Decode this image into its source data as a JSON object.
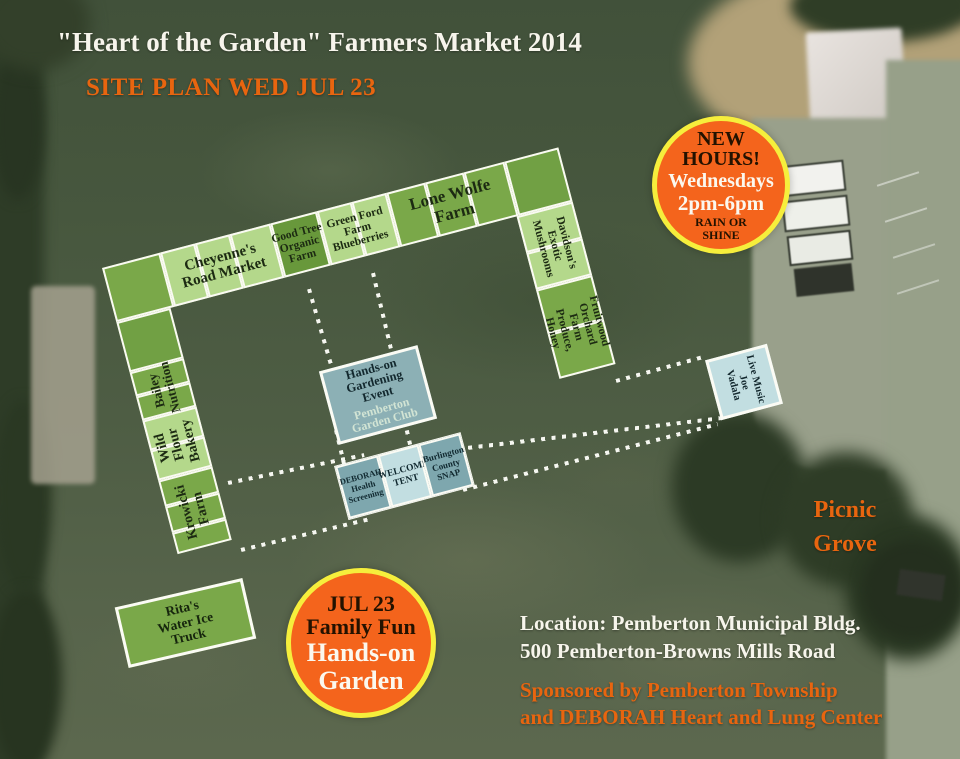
{
  "header": {
    "title": "\"Heart of the Garden\" Farmers Market 2014",
    "subtitle": "SITE PLAN WED JUL 23"
  },
  "new_hours_badge": {
    "l1": "NEW",
    "l2": "HOURS!",
    "l3": "Wednesdays",
    "l4": "2pm-6pm",
    "l5": "RAIN OR",
    "l6": "SHINE"
  },
  "family_fun_badge": {
    "l1": "JUL 23",
    "l2": "Family Fun",
    "l3": "Hands-on",
    "l4": "Garden"
  },
  "market": {
    "cheyennes": "Cheyenne's\nRoad Market",
    "good_tree": "Good Tree\nOrganic\nFarm",
    "green_ford": "Green Ford\nFarm\nBlueberries",
    "lone_wolfe": "Lone Wolfe\nFarm",
    "bailey": "Bailey\nNutrition",
    "wild_flour": "Wild\nFlour\nBakery",
    "krowicki": "Krowicki\nFarm",
    "davidsons": "Davidson's\nExotic\nMushrooms",
    "fruitwood": "Fruitwood\nOrchard Farm\nProduce, Honey"
  },
  "booths": {
    "hands_on_title": "Hands-on\nGardening\nEvent",
    "hands_on_subtitle": "Pemberton\nGarden Club",
    "deborah": "DEBORAH\nHealth\nScreening",
    "welcome": "WELCOME\nTENT",
    "snap": "Burlington\nCounty\nSNAP",
    "live_music": "Live Music\nJoe\nVadala",
    "ritas": "Rita's\nWater Ice\nTruck"
  },
  "labels": {
    "picnic_grove": "Picnic\nGrove",
    "location_line1": "Location: Pemberton Municipal Bldg.",
    "location_line2": "500 Pemberton-Browns Mills Road",
    "sponsored_line1": "Sponsored by Pemberton Township",
    "sponsored_line2": "and DEBORAH Heart and Lung Center"
  },
  "colors": {
    "accent_orange": "#e8650f",
    "badge_orange": "#f4641c",
    "badge_yellow_ring": "#f6ee3c",
    "vendor_light_green": "#b4d88b",
    "vendor_medium_green": "#7aa849",
    "vendor_dark_green": "#68983b",
    "booth_teal_dark": "#7ea7ae",
    "booth_teal_light": "#c2dee1",
    "text_white": "#f7f5ec"
  }
}
